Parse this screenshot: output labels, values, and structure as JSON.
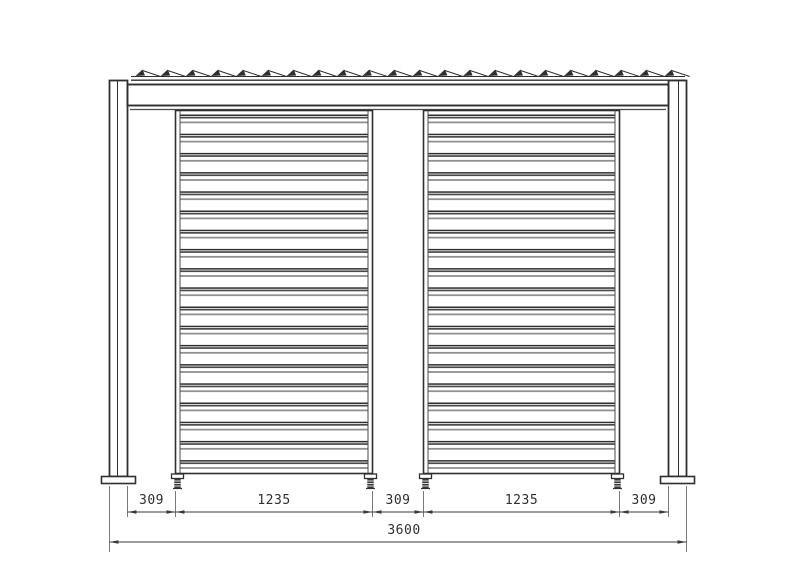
{
  "drawing": {
    "dimension_labels": {
      "segments": [
        "309",
        "1235",
        "309",
        "1235",
        "309"
      ],
      "overall": "3600"
    },
    "counts": {
      "roof_clips": 22,
      "louvers_per_panel": 19,
      "panels": 2,
      "posts": 2,
      "feet": 4
    },
    "colors": {
      "line": "#2f2f2f",
      "line_medium": "#4a4a4a",
      "line_light": "#909090",
      "dim_line": "#3a3a3a",
      "background": "#ffffff"
    }
  }
}
